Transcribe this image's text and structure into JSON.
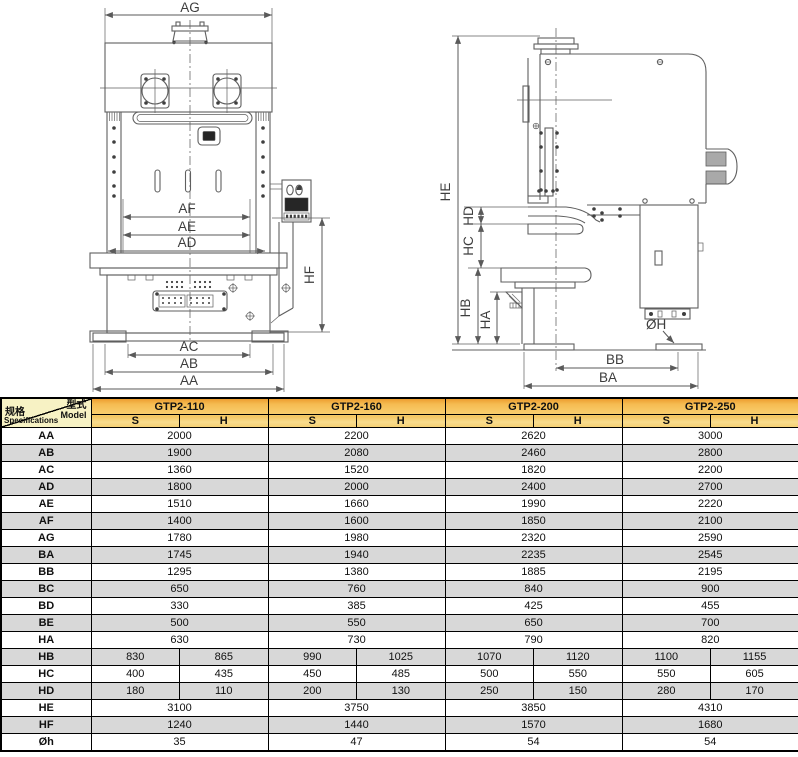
{
  "drawing": {
    "front": {
      "ag": "AG",
      "af": "AF",
      "ae": "AE",
      "ad": "AD",
      "hf": "HF",
      "ac": "AC",
      "ab": "AB",
      "aa": "AA"
    },
    "side": {
      "he": "HE",
      "hd": "HD",
      "hc": "HC",
      "hb": "HB",
      "ha": "HA",
      "oh": "ØH",
      "bb": "BB",
      "ba": "BA"
    }
  },
  "table": {
    "corner": {
      "type_cn": "型式",
      "type_en": "Model",
      "spec_cn": "规格",
      "spec_en": "Specifications"
    },
    "models": [
      "GTP2-110",
      "GTP2-160",
      "GTP2-200",
      "GTP2-250"
    ],
    "sub_headers": [
      "S",
      "H"
    ],
    "rows": [
      {
        "label": "AA",
        "values": [
          [
            "2000"
          ],
          [
            "2200"
          ],
          [
            "2620"
          ],
          [
            "3000"
          ]
        ]
      },
      {
        "label": "AB",
        "values": [
          [
            "1900"
          ],
          [
            "2080"
          ],
          [
            "2460"
          ],
          [
            "2800"
          ]
        ]
      },
      {
        "label": "AC",
        "values": [
          [
            "1360"
          ],
          [
            "1520"
          ],
          [
            "1820"
          ],
          [
            "2200"
          ]
        ]
      },
      {
        "label": "AD",
        "values": [
          [
            "1800"
          ],
          [
            "2000"
          ],
          [
            "2400"
          ],
          [
            "2700"
          ]
        ]
      },
      {
        "label": "AE",
        "values": [
          [
            "1510"
          ],
          [
            "1660"
          ],
          [
            "1990"
          ],
          [
            "2220"
          ]
        ]
      },
      {
        "label": "AF",
        "values": [
          [
            "1400"
          ],
          [
            "1600"
          ],
          [
            "1850"
          ],
          [
            "2100"
          ]
        ]
      },
      {
        "label": "AG",
        "values": [
          [
            "1780"
          ],
          [
            "1980"
          ],
          [
            "2320"
          ],
          [
            "2590"
          ]
        ]
      },
      {
        "label": "BA",
        "values": [
          [
            "1745"
          ],
          [
            "1940"
          ],
          [
            "2235"
          ],
          [
            "2545"
          ]
        ]
      },
      {
        "label": "BB",
        "values": [
          [
            "1295"
          ],
          [
            "1380"
          ],
          [
            "1885"
          ],
          [
            "2195"
          ]
        ]
      },
      {
        "label": "BC",
        "values": [
          [
            "650"
          ],
          [
            "760"
          ],
          [
            "840"
          ],
          [
            "900"
          ]
        ]
      },
      {
        "label": "BD",
        "values": [
          [
            "330"
          ],
          [
            "385"
          ],
          [
            "425"
          ],
          [
            "455"
          ]
        ]
      },
      {
        "label": "BE",
        "values": [
          [
            "500"
          ],
          [
            "550"
          ],
          [
            "650"
          ],
          [
            "700"
          ]
        ]
      },
      {
        "label": "HA",
        "values": [
          [
            "630"
          ],
          [
            "730"
          ],
          [
            "790"
          ],
          [
            "820"
          ]
        ]
      },
      {
        "label": "HB",
        "values": [
          [
            "830",
            "865"
          ],
          [
            "990",
            "1025"
          ],
          [
            "1070",
            "1120"
          ],
          [
            "1100",
            "1155"
          ]
        ]
      },
      {
        "label": "HC",
        "values": [
          [
            "400",
            "435"
          ],
          [
            "450",
            "485"
          ],
          [
            "500",
            "550"
          ],
          [
            "550",
            "605"
          ]
        ]
      },
      {
        "label": "HD",
        "values": [
          [
            "180",
            "110"
          ],
          [
            "200",
            "130"
          ],
          [
            "250",
            "150"
          ],
          [
            "280",
            "170"
          ]
        ]
      },
      {
        "label": "HE",
        "values": [
          [
            "3100"
          ],
          [
            "3750"
          ],
          [
            "3850"
          ],
          [
            "4310"
          ]
        ]
      },
      {
        "label": "HF",
        "values": [
          [
            "1240"
          ],
          [
            "1440"
          ],
          [
            "1570"
          ],
          [
            "1680"
          ]
        ]
      },
      {
        "label": "Øh",
        "values": [
          [
            "35"
          ],
          [
            "47"
          ],
          [
            "54"
          ],
          [
            "54"
          ]
        ]
      }
    ]
  },
  "colors": {
    "header_orange": "#ED9D2F",
    "header_gold": "#F9CE6E",
    "subheader_gold": "#F8DC8E",
    "corner_yellow": "#F7F2C4",
    "row_stripe": "#D8D8D8",
    "line_gray": "#5a5a5a"
  }
}
